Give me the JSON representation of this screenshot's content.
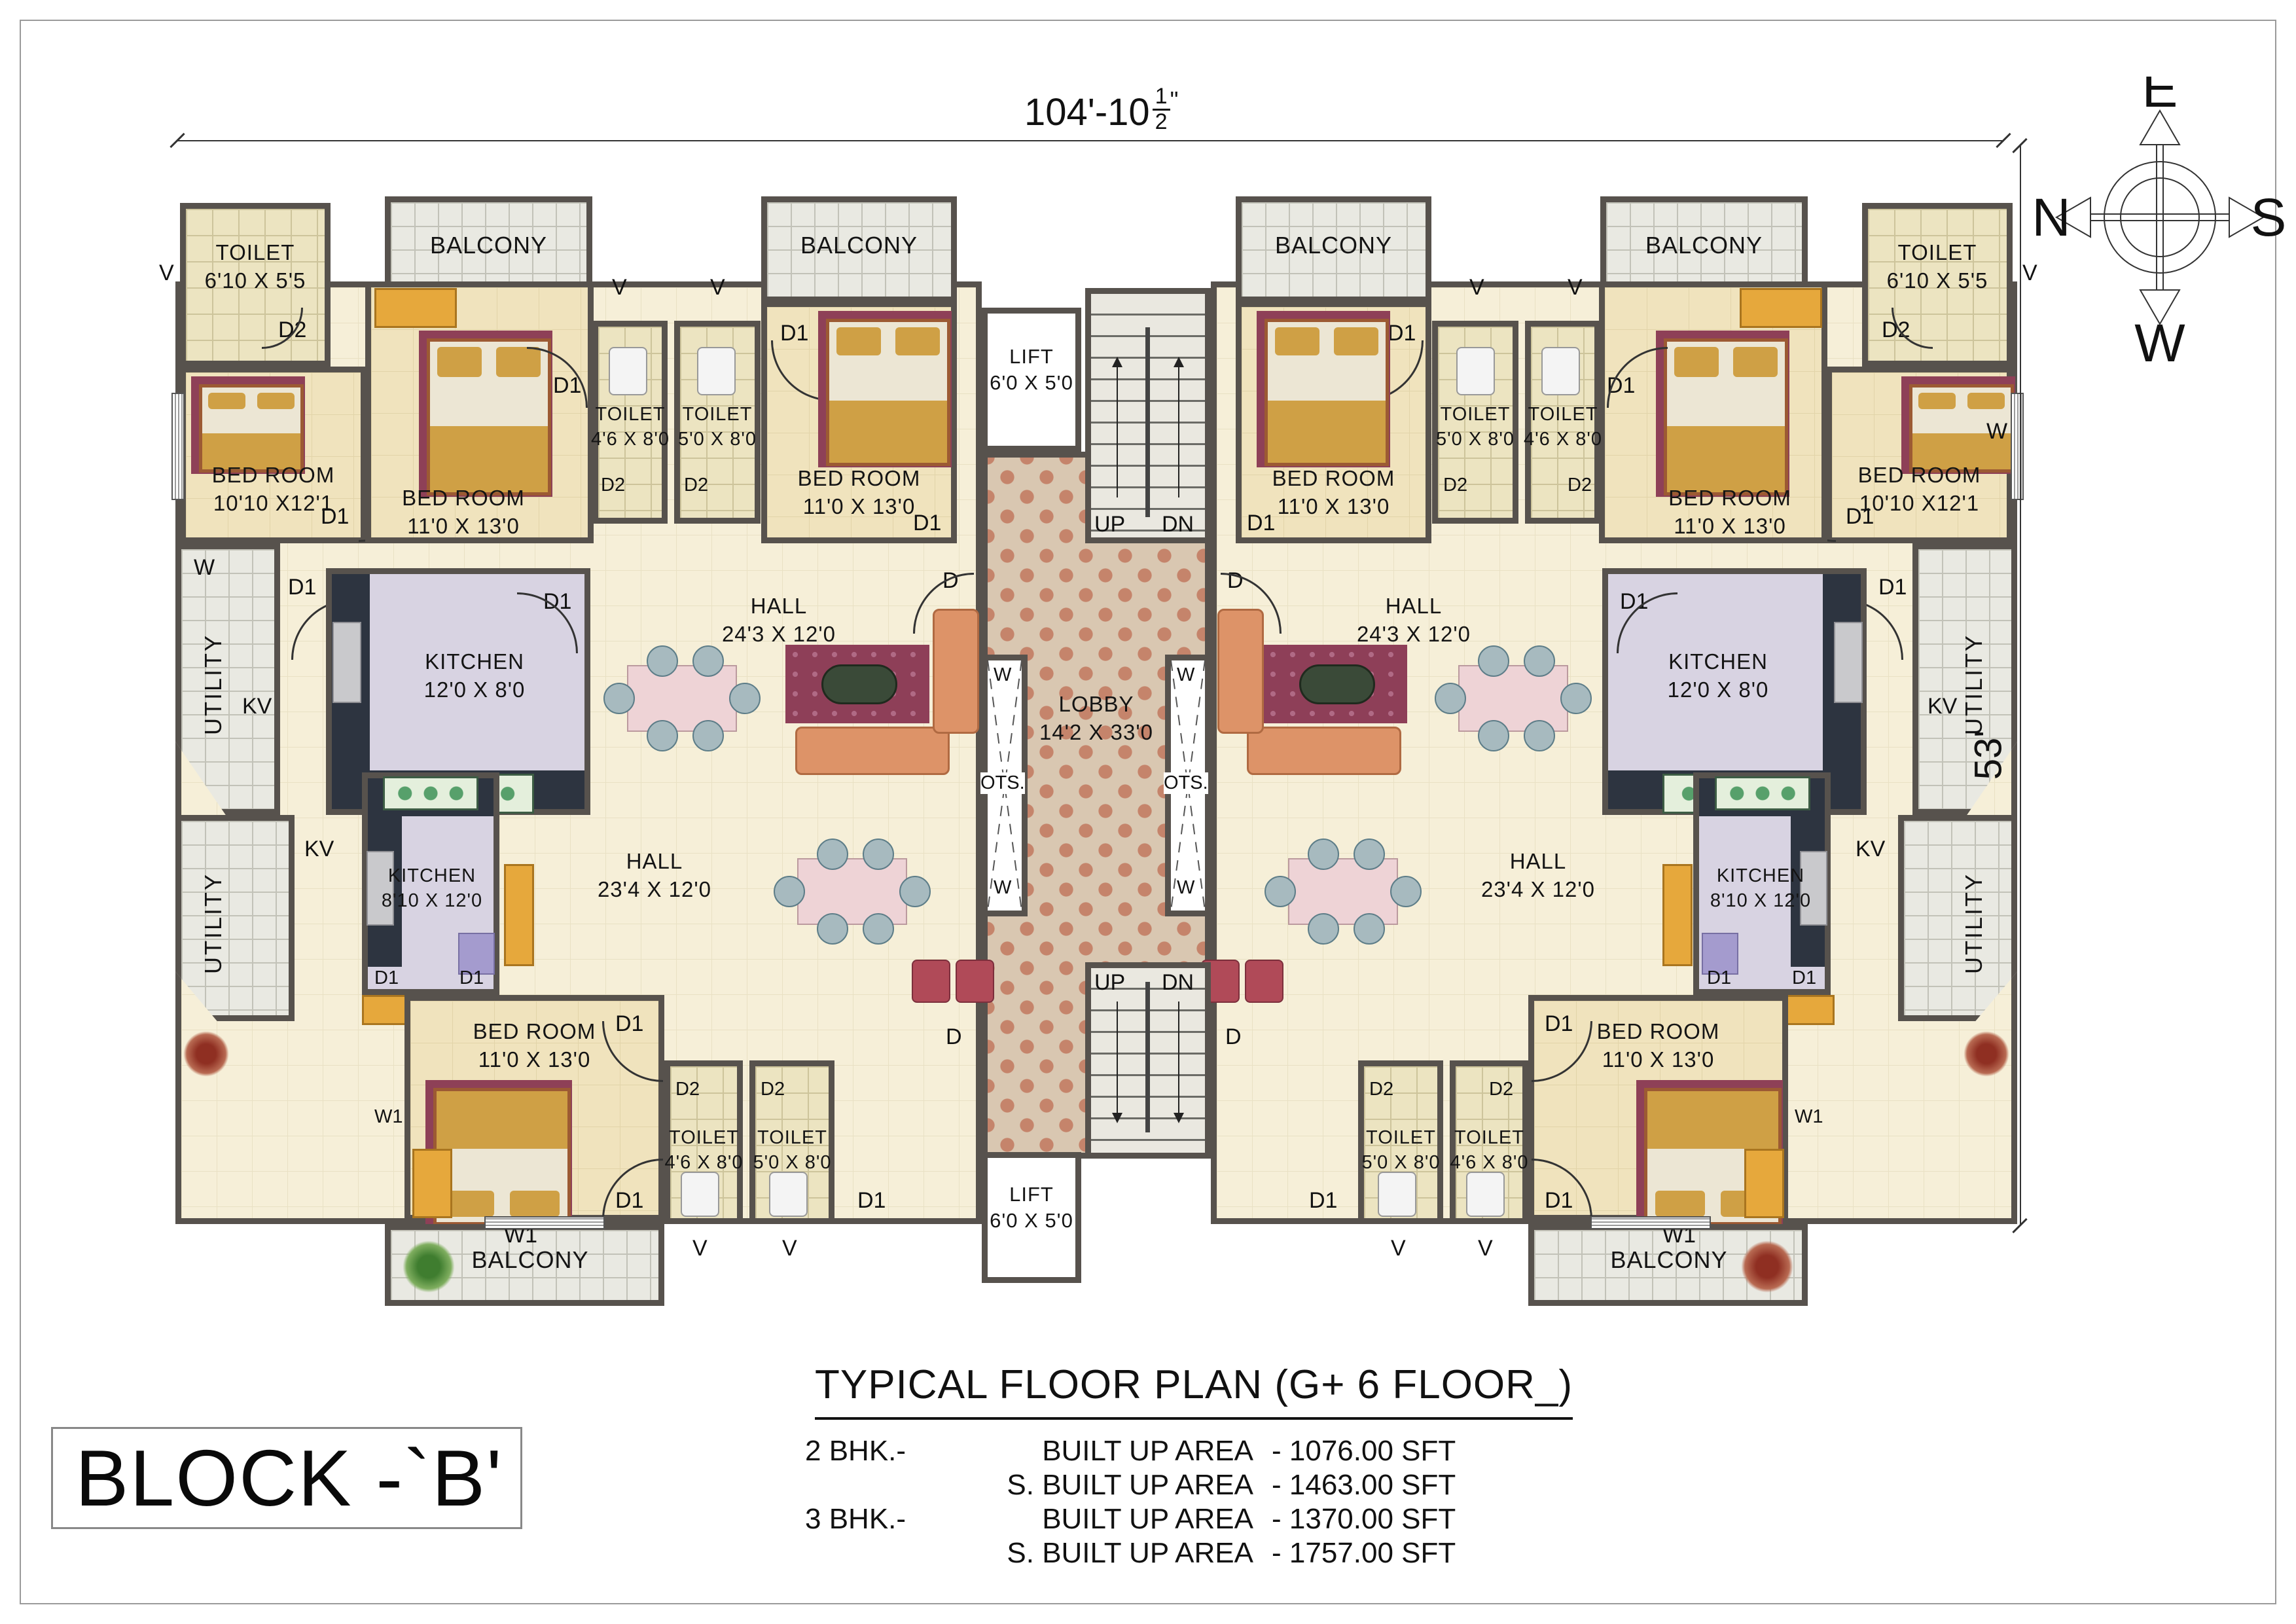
{
  "sheet": {
    "type": "architectural floor plan drawing"
  },
  "title_block": {
    "title": "TYPICAL FLOOR PLAN  (G+ 6 FLOOR_)",
    "rows": [
      {
        "bhk": "2 BHK.-",
        "item": "BUILT UP AREA",
        "value": "- 1076.00 SFT"
      },
      {
        "bhk": "",
        "item": "S. BUILT UP AREA",
        "value": "- 1463.00 SFT"
      },
      {
        "bhk": "3 BHK.-",
        "item": "BUILT UP AREA",
        "value": "- 1370.00 SFT"
      },
      {
        "bhk": "",
        "item": "S. BUILT UP AREA",
        "value": "- 1757.00 SFT"
      }
    ]
  },
  "block_label": "BLOCK -`B'",
  "dimensions": {
    "width_feet": "104'-10",
    "width_frac_num": "1",
    "width_frac_den": "2",
    "width_unit": "\"",
    "height": "53'"
  },
  "compass": {
    "top": "E",
    "left": "N",
    "right": "S",
    "bottom": "W"
  },
  "rooms": {
    "toilet_corner": {
      "name": "TOILET",
      "dims": "6'10 X 5'5"
    },
    "balcony": {
      "name": "BALCONY"
    },
    "bedroom_a": {
      "name": "BED ROOM",
      "dims": "10'10 X12'1"
    },
    "bedroom_b": {
      "name": "BED ROOM",
      "dims": "11'0 X 13'0"
    },
    "toilet_46": {
      "name": "TOILET",
      "dims": "4'6 X 8'0"
    },
    "toilet_50": {
      "name": "TOILET",
      "dims": "5'0 X 8'0"
    },
    "lift": {
      "name": "LIFT",
      "dims": "6'0 X 5'0"
    },
    "lobby": {
      "name": "LOBBY",
      "dims": "14'2 X 33'0"
    },
    "hall_a": {
      "name": "HALL",
      "dims": "24'3 X 12'0"
    },
    "hall_b": {
      "name": "HALL",
      "dims": "23'4 X 12'0"
    },
    "kitchen_a": {
      "name": "KITCHEN",
      "dims": "12'0 X 8'0"
    },
    "kitchen_b": {
      "name": "KITCHEN",
      "dims": "8'10 X 12'0"
    },
    "utility": {
      "name": "UTILITY"
    }
  },
  "marks": {
    "d": "D",
    "d1": "D1",
    "d2": "D2",
    "w": "W",
    "w1": "W1",
    "v": "V",
    "kv": "KV",
    "ots": "OTS.",
    "up": "UP",
    "dn": "DN"
  }
}
